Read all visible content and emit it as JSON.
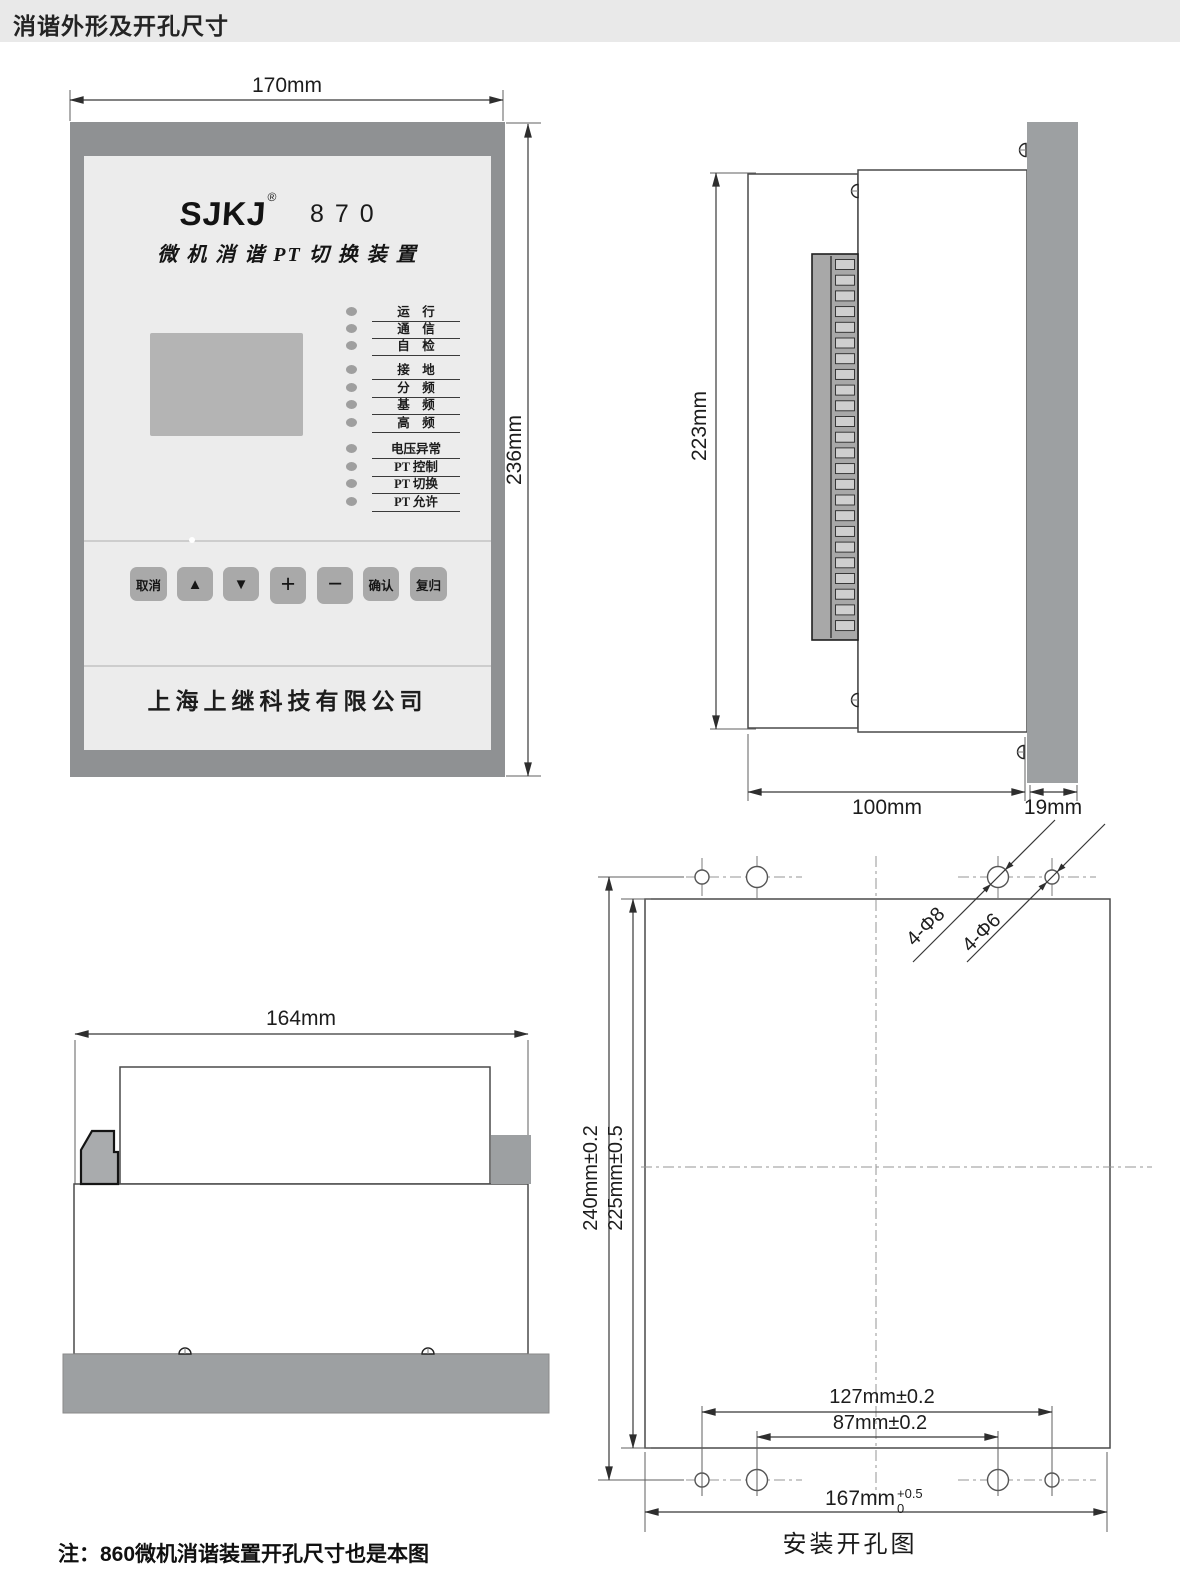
{
  "header": {
    "title": "消谐外形及开孔尺寸"
  },
  "front_view": {
    "brand": "SJKJ",
    "reg_mark": "®",
    "model": "870",
    "device_title": "微 机 消 谐 PT 切 换 装 置",
    "leds": [
      "运　行",
      "通　信",
      "自　检",
      "接　地",
      "分　频",
      "基　频",
      "高　频",
      "电压异常",
      "PT 控制",
      "PT 切换",
      "PT 允许"
    ],
    "buttons": [
      "取消",
      "▲",
      "▼",
      "+",
      "−",
      "确认",
      "复归"
    ],
    "company": "上海上继科技有限公司",
    "dim_width": "170mm",
    "dim_height": "236mm"
  },
  "side_view": {
    "dim_height": "223mm",
    "dim_depth": "100mm",
    "dim_panel_thickness": "19mm"
  },
  "top_view": {
    "dim_width": "164mm"
  },
  "install_view": {
    "caption": "安装开孔图",
    "dim_hole_span_vertical": "240mm±0.2",
    "dim_cutout_height": "225mm±0.5",
    "dim_outer_hole_span": "127mm±0.2",
    "dim_inner_hole_span": "87mm±0.2",
    "dim_cutout_width": "167mm",
    "dim_cutout_width_tol_upper": "+0.5",
    "dim_cutout_width_tol_lower": "0",
    "label_large_holes": "4-Φ8",
    "label_small_holes": "4-Φ6"
  },
  "note": {
    "text": "注：860微机消谐装置开孔尺寸也是本图"
  },
  "colors": {
    "header_bg": "#e9e9e9",
    "frame_gray": "#8f9193",
    "panel_face": "#ececec",
    "control_gray": "#a9a9a9",
    "metal_gray": "#9da0a2",
    "line": "#4a4a4a"
  }
}
